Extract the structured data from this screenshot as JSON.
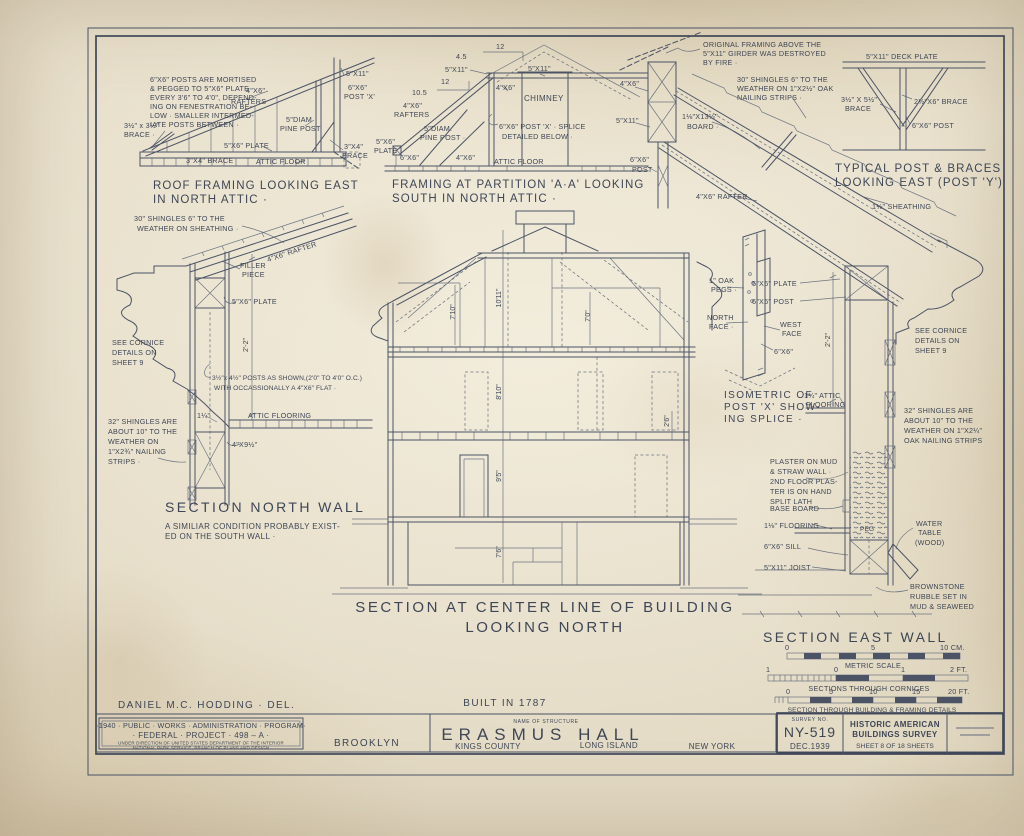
{
  "sheet": {
    "built_in": "BUILT IN 1787",
    "delineator": "DANIEL M.C. HODDING · DEL."
  },
  "roof_framing": {
    "caption1": "ROOF FRAMING LOOKING EAST",
    "caption2": "IN NORTH ATTIC ·",
    "note": [
      "6\"X6\" POSTS ARE MORTISED",
      "& PEGGED TO 5\"X6\" PLATE",
      "EVERY 3'6\" TO 4'0\", DEPEND-",
      "ING ON FENESTRATION BE-",
      "LOW · SMALLER INTERMED-",
      "IATE POSTS BETWEEN ·"
    ],
    "brace_sm1": "3½\" x 3½\"",
    "brace_sm2": "BRACE ·",
    "rafters1": "4\"X6\"",
    "rafters2": "RAFTERS",
    "pine1": "5\"DIAM",
    "pine2": "PINE POST",
    "plate": "5\"X6\" PLATE",
    "brace34": "3\"X4\" BRACE",
    "attic_floor": "ATTIC FLOOR",
    "g511": "5\"X11\"",
    "post1": "6\"X6\"",
    "post2": "POST 'X'",
    "brace_r1": "3\"X4\"",
    "brace_r2": "BRACE"
  },
  "partition": {
    "caption1": "FRAMING AT PARTITION 'A·A' LOOKING",
    "caption2": "SOUTH IN NORTH ATTIC ·",
    "slope1_rise": "4.5",
    "slope1_run": "12",
    "slope2_rise": "10.5",
    "slope2_run": "12",
    "g511_l": "5\"X11\"",
    "g511_c": "5\"X11\"",
    "r46": "4\"X6\"",
    "chimney": "CHIMNEY",
    "rafters1": "4\"X6\"",
    "rafters2": "RAFTERS",
    "pine1": "5\"DIAM.",
    "pine2": "PINE POST ·",
    "splice1": "6\"X6\" POST 'X' · SPLICE",
    "splice2": "DETAILED BELOW ·",
    "plate1": "5\"X6\"",
    "plate2": "PLATE ·",
    "p66": "6\"X6\"",
    "b46": "4\"X6\"",
    "attic_floor": "ATTIC FLOOR"
  },
  "fire_note": [
    "ORIGINAL FRAMING ABOVE THE",
    "5\"X11\" GIRDER WAS DESTROYED",
    "BY FIRE ·"
  ],
  "east_roof": {
    "shingle_note": [
      "30\" SHINGLES 6\" TO THE",
      "WEATHER ON 1\"X2½\" OAK",
      "NAILING STRIPS ·"
    ],
    "r46": "4\"X6\"",
    "g511": "5\"X11\"",
    "board1": "1⅛\"X13½\"",
    "board2": "BOARD ·",
    "post1": "6\"X6\"",
    "post2": "POST",
    "rafter": "4\"X6\" RAFTER",
    "sheathing": "1⅛\" SHEATHING"
  },
  "post_y": {
    "caption1": "TYPICAL POST & BRACES",
    "caption2": "LOOKING EAST (POST 'Y')",
    "deck_plate": "5\"X11\" DECK PLATE",
    "brace_l1": "3½\" X 5½\"",
    "brace_l2": "BRACE",
    "brace_r": "2½\"X6\" BRACE",
    "post": "6\"X6\" POST"
  },
  "north_wall": {
    "caption": "SECTION NORTH WALL",
    "subnote1": "A SIMILIAR CONDITION PROBABLY EXIST-",
    "subnote2": "ED ON THE SOUTH WALL ·",
    "shingle_note1": "30\" SHINGLES 6\" TO THE",
    "shingle_note2": "WEATHER ON SHEATHING ·",
    "filler1": "FILLER",
    "filler2": "PIECE",
    "rafter": "4\"X6\" RAFTER",
    "plate": "5\"X6\" PLATE",
    "cornice_note": [
      "SEE CORNICE",
      "DETAILS ON",
      "SHEET 9"
    ],
    "dim22": "2'-2\"",
    "posts_note1": "3½\"x 4½\" POSTS AS SHOWN,(2'0\" TO 4'0\" O.C.)",
    "posts_note2": "WITH OCCASSIONALLY A 4\"X6\" FLAT ·",
    "floor_dim": "1¼\"",
    "attic_flooring": "ATTIC FLOORING",
    "joist": "4\"X9½\"",
    "shingles32": [
      "32\" SHINGLES ARE",
      "ABOUT 10\" TO THE",
      "WEATHER ON",
      "1\"X2¾\" NAILING",
      "STRIPS ·"
    ]
  },
  "section": {
    "caption1": "SECTION AT CENTER LINE OF BUILDING",
    "caption2": "LOOKING NORTH",
    "dims": {
      "attic_left": "7'10\"",
      "attic_center": "10'11\"",
      "attic_right": "7'0\"",
      "storey2": "8'10\"",
      "storey1": "9'5\"",
      "basement": "7'6\"",
      "knee": "2'6\""
    }
  },
  "isometric": {
    "caption": [
      "ISOMETRIC OF",
      "POST 'X' SHOW-",
      "ING SPLICE ·"
    ],
    "pegs1": "1\" OAK",
    "pegs2": "PEGS ·",
    "north1": "NORTH",
    "north2": "FACE ·",
    "west1": "WEST",
    "west2": "FACE",
    "size": "6\"X6\""
  },
  "east_wall": {
    "caption": "SECTION EAST WALL",
    "plate": "5\"X6\" PLATE",
    "post": "6\"X6\" POST",
    "dim22": "2'-2\"",
    "floor1": "1¼\" ATTIC",
    "floor2": "FLOORING",
    "cornice_note": [
      "SEE CORNICE",
      "DETAILS ON",
      "SHEET 9"
    ],
    "shingles32": [
      "32\" SHINGLES ARE",
      "ABOUT 10\" TO THE",
      "WEATHER ON 1\"X2¼\"",
      "OAK NAILING STRIPS"
    ],
    "plaster_note": [
      "PLASTER ON MUD",
      "& STRAW WALL ·",
      "2ND FLOOR PLAS-",
      "TER IS ON HAND",
      "SPLIT LATH"
    ],
    "base_board": "BASE BOARD",
    "flooring118": "1⅛\" FLOORING",
    "sill": "6\"X6\" SILL",
    "joist": "5\"X11\" JOIST",
    "peg": "PEG",
    "water": [
      "WATER",
      "TABLE",
      "(WOOD)"
    ],
    "brownstone": [
      "BROWNSTONE",
      "RUBBLE SET IN",
      "MUD & SEAWEED"
    ]
  },
  "scales": {
    "metric": {
      "t0": "0",
      "t5": "5",
      "t10": "10 CM.",
      "label": "METRIC SCALE"
    },
    "cornice": {
      "t1": "1",
      "t0": "0",
      "t1b": "1",
      "t2": "2 FT.",
      "label": "SECTIONS THROUGH CORNICES"
    },
    "building": {
      "t0": "0",
      "t5": "5",
      "t10": "10",
      "t15": "15",
      "t20": "20 FT.",
      "label": "SECTION THROUGH BUILDING & FRAMING DETAILS"
    }
  },
  "title_block": {
    "pwa1": "·1940 · PUBLIC · WORKS · ADMINISTRATION · PROGRAM·",
    "pwa2": "· FEDERAL · PROJECT · 498 – A ·",
    "pwa3": "UNDER DIRECTION OF UNITED STATES DEPARTMENT OF THE INTERIOR",
    "pwa4": "NATIONAL PARK SERVICE, BRANCH OF PLANS AND DESIGN",
    "borough": "BROOKLYN",
    "name_label": "NAME OF STRUCTURE",
    "structure": "ERASMUS HALL",
    "county": "KINGS COUNTY",
    "island": "LONG ISLAND",
    "state": "NEW YORK",
    "survey_label": "SURVEY NO.",
    "survey_no": "NY-519",
    "survey_date": "DEC.1939",
    "habs1": "HISTORIC AMERICAN",
    "habs2": "BUILDINGS SURVEY",
    "sheet_line": "SHEET 8 OF 18 SHEETS"
  }
}
